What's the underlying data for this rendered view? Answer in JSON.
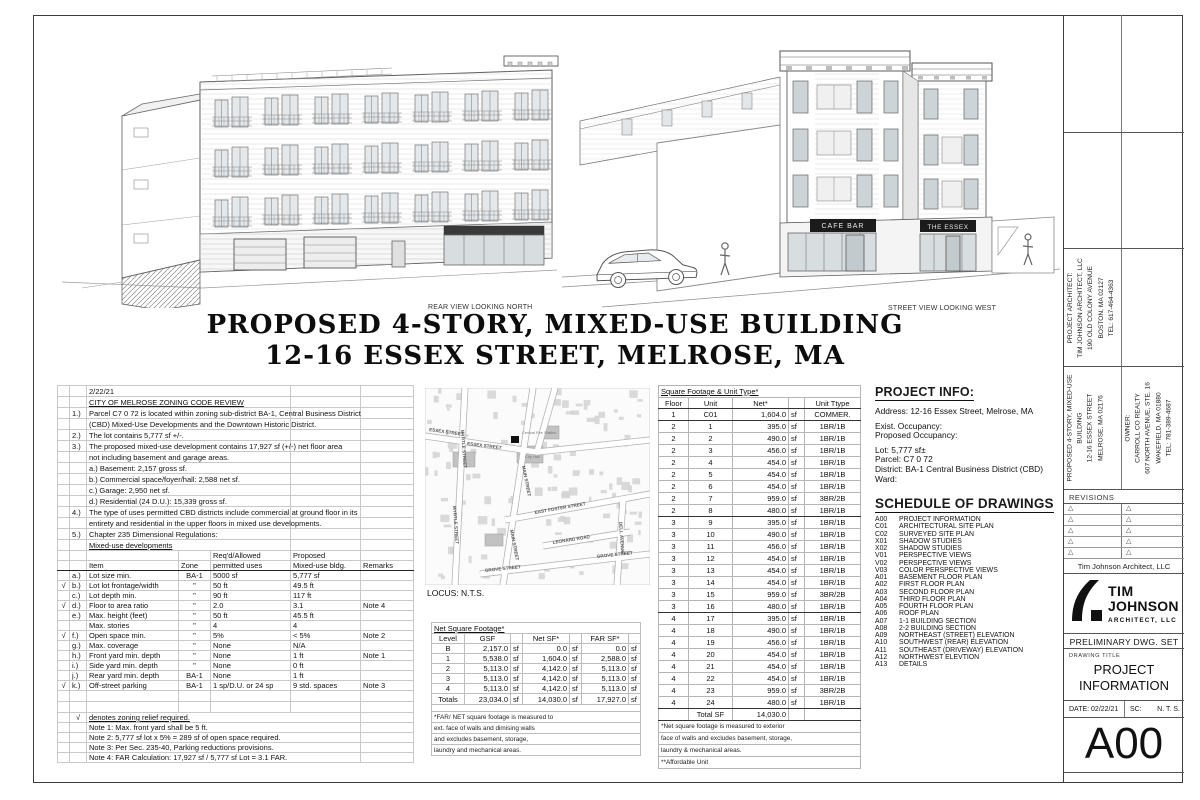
{
  "sheet": {
    "caption_rear": "REAR VIEW LOOKING NORTH",
    "caption_street": "STREET VIEW LOOKING WEST",
    "title_line1": "PROPOSED 4-STORY, MIXED-USE BUILDING",
    "title_line2": "12-16 ESSEX STREET, MELROSE, MA"
  },
  "renders": {
    "street_signs": [
      "CAFE BAR",
      "THE ESSEX"
    ]
  },
  "zoning": {
    "upper_rows": [
      {
        "n": "",
        "t": "2/22/21"
      },
      {
        "n": "",
        "t": "CITY OF MELROSE ZONING CODE REVIEW",
        "u": true
      },
      {
        "n": "1.)",
        "t": "Parcel C7 0 72 is located within zoning sub-district BA-1, Central Business District"
      },
      {
        "n": "",
        "t": "(CBD) Mixed-Use Developments and the Downtown Historic District."
      },
      {
        "n": "2.)",
        "t": "The lot contains 5,777 sf +/-."
      },
      {
        "n": "3.)",
        "t": "The proposed mixed-use development contains 17,927 sf (+/-) net floor area"
      },
      {
        "n": "",
        "t": "not including basement and garage areas."
      },
      {
        "n": "",
        "t": "a.) Basement: 2,157 gross sf."
      },
      {
        "n": "",
        "t": "b.) Commercial space/foyer/hall: 2,588 net sf."
      },
      {
        "n": "",
        "t": "c.) Garage: 2,950 net sf."
      },
      {
        "n": "",
        "t": "d.) Residential (24 D.U.): 15,339 gross sf."
      },
      {
        "n": "4.)",
        "t": "The type of uses permitted CBD districts include commercial at ground floor in its"
      },
      {
        "n": "",
        "t": "entirety and residential in the upper floors in mixed use developments."
      },
      {
        "n": "5.)",
        "t": "Chapter 235 Dimensional Regulations:"
      },
      {
        "n": "",
        "t": "Mixed-use developments",
        "u": true
      }
    ],
    "header1": [
      "",
      "",
      "",
      "",
      "Req'd/Allowed",
      "Proposed",
      ""
    ],
    "header2": [
      "",
      "",
      "Item",
      "Zone",
      "permitted uses",
      "Mixed-use bldg.",
      "Remarks"
    ],
    "check_mark": "√",
    "dim_rows": [
      {
        "c": "",
        "l": "a.)",
        "item": "Lot size min.",
        "zone": "BA-1",
        "req": "5000 sf",
        "prop": "5,777 sf",
        "rem": ""
      },
      {
        "c": "√",
        "l": "b.)",
        "item": "Lot lot frontage/width",
        "zone": "\"",
        "req": "50 ft",
        "prop": "49.5 ft",
        "rem": ""
      },
      {
        "c": "",
        "l": "c.)",
        "item": "Lot depth min.",
        "zone": "\"",
        "req": "90 ft",
        "prop": "117 ft",
        "rem": ""
      },
      {
        "c": "√",
        "l": "d.)",
        "item": "Floor to area ratio",
        "zone": "\"",
        "req": "2.0",
        "prop": "3.1",
        "rem": "Note 4"
      },
      {
        "c": "",
        "l": "e.)",
        "item": "Max. height (feet)",
        "zone": "\"",
        "req": "50 ft",
        "prop": "45.5 ft",
        "rem": ""
      },
      {
        "c": "",
        "l": "",
        "item": "Max. stories",
        "zone": "\"",
        "req": "4",
        "prop": "4",
        "rem": ""
      },
      {
        "c": "√",
        "l": "f.)",
        "item": "Open space min.",
        "zone": "\"",
        "req": "5%",
        "prop": "< 5%",
        "rem": "Note 2"
      },
      {
        "c": "",
        "l": "g.)",
        "item": "Max. coverage",
        "zone": "\"",
        "req": "None",
        "prop": "N/A",
        "rem": ""
      },
      {
        "c": "",
        "l": "h.)",
        "item": "Front yard min. depth",
        "zone": "\"",
        "req": "None",
        "prop": "1 ft",
        "rem": "Note 1"
      },
      {
        "c": "",
        "l": "i.)",
        "item": "Side yard min. depth",
        "zone": "\"",
        "req": "None",
        "prop": "0 ft",
        "rem": ""
      },
      {
        "c": "",
        "l": "j.)",
        "item": "Rear yard min. depth",
        "zone": "BA-1",
        "req": "None",
        "prop": "1 ft",
        "rem": ""
      },
      {
        "c": "√",
        "l": "k.)",
        "item": "Off-street parking",
        "zone": "BA-1",
        "req": "1 sp/D.U. or 24 sp",
        "prop": "9 std. spaces",
        "rem": "Note 3"
      }
    ],
    "footer_rows": [
      {
        "c": "√",
        "t": "denotes zoning relief required.",
        "u": true
      },
      {
        "c": "",
        "t": "Note 1: Max. front yard shall be 5 ft."
      },
      {
        "c": "",
        "t": "Note 2: 5,777 sf lot x 5% = 289 sf of open space required."
      },
      {
        "c": "",
        "t": "Note 3: Per Sec. 235-40, Parking reductions provisions."
      },
      {
        "c": "",
        "t": "Note 4: FAR Calculation: 17,927 sf / 5,777 sf Lot = 3.1 FAR."
      }
    ]
  },
  "map": {
    "locus": "LOCUS: N.T.S.",
    "labels": [
      "ESSEX STREET",
      "ESSEX STREET",
      "MYRTLE STREET",
      "MYRTLE STREET",
      "MAIN STREET",
      "MAIN STREET",
      "EAST FOSTER STREET",
      "LEONARD ROAD",
      "GROVE STREET",
      "GROVE STREET",
      "DELL AVENUE",
      "Central Fire Station",
      "City Hall"
    ]
  },
  "netsf": {
    "title": "Net Square Footage*",
    "headers": [
      "Level",
      "GSF",
      "",
      "Net SF*",
      "",
      "FAR SF*",
      ""
    ],
    "sf": "sf",
    "rows": [
      {
        "l": "B",
        "g": "2,157.0",
        "n": "0.0",
        "f": "0.0"
      },
      {
        "l": "1",
        "g": "5,538.0",
        "n": "1,604.0",
        "f": "2,588.0"
      },
      {
        "l": "2",
        "g": "5,113.0",
        "n": "4,142.0",
        "f": "5,113.0"
      },
      {
        "l": "3",
        "g": "5,113.0",
        "n": "4,142.0",
        "f": "5,113.0"
      },
      {
        "l": "4",
        "g": "5,113.0",
        "n": "4,142.0",
        "f": "5,113.0"
      }
    ],
    "totals": {
      "l": "Totals",
      "g": "23,034.0",
      "n": "14,030.0",
      "f": "17,927.0"
    },
    "footnotes": [
      "*FAR/ NET square footage is measured to",
      "ext. face of walls and dimising walls",
      "and excludes basement, storage,",
      "laundry and mechanical areas."
    ]
  },
  "units": {
    "title": "Square Footage & Unit Type*",
    "headers": [
      "Floor",
      "Unit",
      "Net*",
      "",
      "Unit Ttype"
    ],
    "rows": [
      {
        "f": "1",
        "u": "C01",
        "n": "1,604.0",
        "s": "sf",
        "t": "COMMER.",
        "g": true
      },
      {
        "f": "2",
        "u": "1",
        "n": "395.0",
        "s": "sf",
        "t": "1BR/1B"
      },
      {
        "f": "2",
        "u": "2",
        "n": "490.0",
        "s": "sf",
        "t": "1BR/1B"
      },
      {
        "f": "2",
        "u": "3",
        "n": "456.0",
        "s": "sf",
        "t": "1BR/1B"
      },
      {
        "f": "2",
        "u": "4",
        "n": "454.0",
        "s": "sf",
        "t": "1BR/1B"
      },
      {
        "f": "2",
        "u": "5",
        "n": "454.0",
        "s": "sf",
        "t": "1BR/1B"
      },
      {
        "f": "2",
        "u": "6",
        "n": "454.0",
        "s": "sf",
        "t": "1BR/1B"
      },
      {
        "f": "2",
        "u": "7",
        "n": "959.0",
        "s": "sf",
        "t": "3BR/2B"
      },
      {
        "f": "2",
        "u": "8",
        "n": "480.0",
        "s": "sf",
        "t": "1BR/1B",
        "g": true
      },
      {
        "f": "3",
        "u": "9",
        "n": "395.0",
        "s": "sf",
        "t": "1BR/1B"
      },
      {
        "f": "3",
        "u": "10",
        "n": "490.0",
        "s": "sf",
        "t": "1BR/1B"
      },
      {
        "f": "3",
        "u": "11",
        "n": "456.0",
        "s": "sf",
        "t": "1BR/1B"
      },
      {
        "f": "3",
        "u": "12",
        "n": "454.0",
        "s": "sf",
        "t": "1BR/1B"
      },
      {
        "f": "3",
        "u": "13",
        "n": "454.0",
        "s": "sf",
        "t": "1BR/1B"
      },
      {
        "f": "3",
        "u": "14",
        "n": "454.0",
        "s": "sf",
        "t": "1BR/1B"
      },
      {
        "f": "3",
        "u": "15",
        "n": "959.0",
        "s": "sf",
        "t": "3BR/2B"
      },
      {
        "f": "3",
        "u": "16",
        "n": "480.0",
        "s": "sf",
        "t": "1BR/1B",
        "g": true
      },
      {
        "f": "4",
        "u": "17",
        "n": "395.0",
        "s": "sf",
        "t": "1BR/1B"
      },
      {
        "f": "4",
        "u": "18",
        "n": "490.0",
        "s": "sf",
        "t": "1BR/1B"
      },
      {
        "f": "4",
        "u": "19",
        "n": "456.0",
        "s": "sf",
        "t": "1BR/1B"
      },
      {
        "f": "4",
        "u": "20",
        "n": "454.0",
        "s": "sf",
        "t": "1BR/1B"
      },
      {
        "f": "4",
        "u": "21",
        "n": "454.0",
        "s": "sf",
        "t": "1BR/1B"
      },
      {
        "f": "4",
        "u": "22",
        "n": "454.0",
        "s": "sf",
        "t": "1BR/1B"
      },
      {
        "f": "4",
        "u": "23",
        "n": "959.0",
        "s": "sf",
        "t": "3BR/2B"
      },
      {
        "f": "4",
        "u": "24",
        "n": "480.0",
        "s": "sf",
        "t": "1BR/1B",
        "g": true
      }
    ],
    "total_row": {
      "u": "Total SF",
      "n": "14,030.0"
    },
    "footnotes": [
      "*Net square footage is measured to exterior",
      "face of walls and excludes basement, storage,",
      "laundry & mechanical areas.",
      "**Affordable Unit"
    ]
  },
  "project_info": {
    "title": "PROJECT INFO:",
    "lines": [
      "Address:  12-16 Essex Street, Melrose, MA",
      "",
      "Exist. Occupancy:",
      "Proposed Occupancy:",
      "",
      "Lot:  5,777 sf±",
      "Parcel:  C7 0 72",
      "District:  BA-1 Central Business District (CBD)",
      "Ward:"
    ]
  },
  "schedule": {
    "title": "SCHEDULE OF DRAWINGS",
    "items": [
      {
        "code": "A00",
        "name": "PROJECT INFORMATION"
      },
      {
        "code": "C01",
        "name": "ARCHITECTURAL SITE PLAN"
      },
      {
        "code": "C02",
        "name": "SURVEYED SITE PLAN"
      },
      {
        "code": "X01",
        "name": "SHADOW STUDIES"
      },
      {
        "code": "X02",
        "name": "SHADOW STUDIES"
      },
      {
        "code": "V01",
        "name": "PERSPECTIVE VIEWS"
      },
      {
        "code": "V02",
        "name": "PERSPECTIVE VIEWS"
      },
      {
        "code": "V03",
        "name": "COLOR PERSPECTIVE VIEWS"
      },
      {
        "code": "A01",
        "name": "BASEMENT FLOOR PLAN"
      },
      {
        "code": "A02",
        "name": "FIRST FLOOR PLAN"
      },
      {
        "code": "A03",
        "name": "SECOND FLOOR PLAN"
      },
      {
        "code": "A04",
        "name": "THIRD FLOOR PLAN"
      },
      {
        "code": "A05",
        "name": "FOURTH FLOOR PLAN"
      },
      {
        "code": "A06",
        "name": "ROOF PLAN"
      },
      {
        "code": "A07",
        "name": "1-1 BUILDING SECTION"
      },
      {
        "code": "A08",
        "name": "2-2 BUILDING SECTION"
      },
      {
        "code": "A09",
        "name": "NORTHEAST (STREET) ELEVATION"
      },
      {
        "code": "A10",
        "name": "SOUTHWEST (REAR) ELEVATION"
      },
      {
        "code": "A11",
        "name": "SOUTHEAST (DRIVEWAY) ELEVATION"
      },
      {
        "code": "A12",
        "name": "NORTHWEST ELEVTION"
      },
      {
        "code": "A13",
        "name": "DETAILS"
      }
    ]
  },
  "titleblock": {
    "architect_lines": [
      "PROJECT ARCHITECT:",
      "TIM JOHNSON ARCHITECT, LLC",
      "190 OLD COLONY AVENUE",
      "BOSTON, MA  02127",
      "TEL: 617-464-4363"
    ],
    "project_lines": [
      "PROPOSED 4-STORY, MIXED-USE",
      "BUILDING",
      "12-16 ESSEX STREET",
      "MELROSE, MA  02176"
    ],
    "owner_lines": [
      "OWNER:",
      "CARROLL CO REALTY",
      "607 NORTH AVENUE, STE. 16",
      "WAKEFIELD, MA 01880",
      "TEL: 781-389-4687"
    ],
    "revisions_label": "REVISIONS",
    "revision_triangle": "△",
    "firm_name": "Tim Johnson Architect, LLC",
    "logo": {
      "l1": "TIM",
      "l2": "JOHNSON",
      "l3": "ARCHITECT, LLC"
    },
    "prelim": "PRELIMINARY DWG. SET",
    "drawing_title_label": "DRAWING TITLE",
    "drawing_title_1": "PROJECT",
    "drawing_title_2": "INFORMATION",
    "date_label": "DATE: 02/22/21",
    "scale_label": "SC:",
    "scale_value": "N. T. S.",
    "sheet_no": "A00"
  },
  "colors": {
    "line": "#777777",
    "glass": "#dfe3e6",
    "sign": "#1b1b1b",
    "map_building": "#d2d2d2"
  }
}
